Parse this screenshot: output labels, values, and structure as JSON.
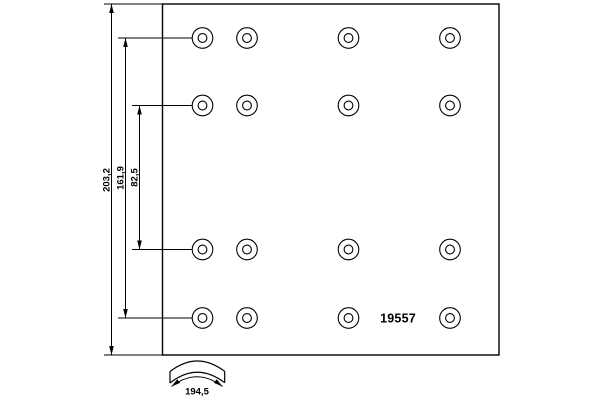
{
  "style": {
    "background": "#ffffff",
    "line_color": "#000000",
    "text_color": "#000000"
  },
  "drawing": {
    "part_number": "19557",
    "outline": {
      "x": 162.5,
      "y": 4,
      "width": 336.5,
      "height": 351
    },
    "holes": {
      "columns_x": [
        202.5,
        247,
        348.5,
        450
      ],
      "rows_y": [
        38,
        105.5,
        249.5,
        318
      ],
      "outer_radius": 10.3,
      "inner_radius": 4.4
    },
    "vertical_dimensions": [
      {
        "label": "203,2",
        "x": 111.5,
        "y1": 4,
        "y2": 355,
        "label_anchor": {
          "x": 109.5,
          "y": 180
        }
      },
      {
        "label": "161,9",
        "x": 125.5,
        "y1": 38,
        "y2": 318,
        "label_anchor": {
          "x": 123.5,
          "y": 178
        }
      },
      {
        "label": "82,5",
        "x": 139.5,
        "y1": 105.5,
        "y2": 249.5,
        "label_anchor": {
          "x": 137.5,
          "y": 177.5
        }
      }
    ],
    "extension_lines": [
      {
        "x1": 104,
        "y1": 4,
        "x2": 162,
        "y2": 4
      },
      {
        "x1": 104,
        "y1": 355,
        "x2": 162,
        "y2": 355
      },
      {
        "x1": 118,
        "y1": 38,
        "x2": 192.5,
        "y2": 38
      },
      {
        "x1": 132,
        "y1": 105.5,
        "x2": 192.5,
        "y2": 105.5
      },
      {
        "x1": 132,
        "y1": 249.5,
        "x2": 192.5,
        "y2": 249.5
      },
      {
        "x1": 118,
        "y1": 318,
        "x2": 192.5,
        "y2": 318
      }
    ],
    "arc_width_dimension": {
      "label": "194,5",
      "arrow_tips": [
        {
          "x": 171.5,
          "y": 386.5,
          "angle": 142.6
        },
        {
          "x": 222.5,
          "y": 386.5,
          "angle": 37.4
        }
      ]
    }
  }
}
